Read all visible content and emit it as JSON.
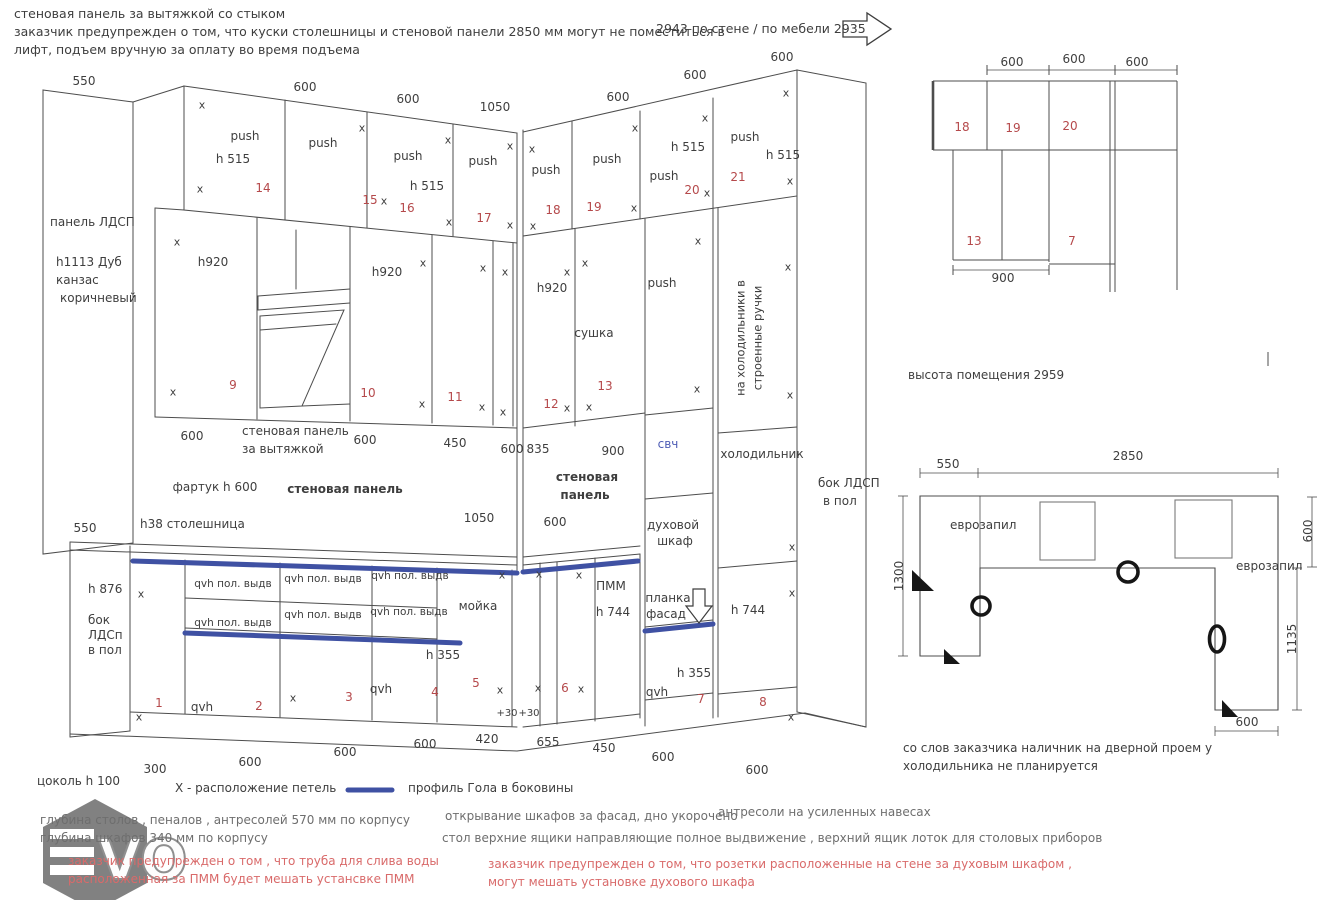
{
  "colors": {
    "ink": "#3e3e3e",
    "red": "#b5494b",
    "blue": "#4d5cb5",
    "gray": "#6e6e6e",
    "rednote": "#d96a6a",
    "gola_blue": "#3f51a3",
    "line": "#4d4d4d"
  },
  "watermark": {
    "v": "V",
    "o": "O"
  },
  "labels": [
    {
      "t": "стеновая панель за вытяжкой со стыком",
      "x": 14,
      "y": 14,
      "fs": 12.5,
      "al": "l",
      "n": "note-wall-panel"
    },
    {
      "t": "заказчик предупрежден о том, что куски столешницы и стеновой панели  2850 мм могут не поместиться в",
      "x": 14,
      "y": 32,
      "fs": 12.5,
      "al": "l",
      "n": "note-lift-1"
    },
    {
      "t": "лифт, подъем вручную за оплату во время подъема",
      "x": 14,
      "y": 50,
      "fs": 12.5,
      "al": "l",
      "n": "note-lift-2"
    },
    {
      "t": "2943 по стене / по мебели 2935",
      "x": 656,
      "y": 29,
      "fs": 12.5,
      "al": "l",
      "n": "wall-length-note"
    },
    {
      "t": "550",
      "x": 84,
      "y": 81
    },
    {
      "t": "600",
      "x": 305,
      "y": 87
    },
    {
      "t": "600",
      "x": 408,
      "y": 99
    },
    {
      "t": "1050",
      "x": 495,
      "y": 107
    },
    {
      "t": "600",
      "x": 618,
      "y": 97
    },
    {
      "t": "600",
      "x": 695,
      "y": 75
    },
    {
      "t": "600",
      "x": 782,
      "y": 57
    },
    {
      "t": "панель ЛДСП",
      "x": 50,
      "y": 222,
      "al": "l"
    },
    {
      "t": "h1113 Дуб",
      "x": 56,
      "y": 262,
      "al": "l"
    },
    {
      "t": "канзас",
      "x": 56,
      "y": 280,
      "al": "l"
    },
    {
      "t": "коричневый",
      "x": 60,
      "y": 298,
      "al": "l"
    },
    {
      "t": "push",
      "x": 245,
      "y": 136
    },
    {
      "t": "h  515",
      "x": 233,
      "y": 159
    },
    {
      "t": "14",
      "x": 263,
      "y": 188,
      "c": "red"
    },
    {
      "t": "push",
      "x": 323,
      "y": 143
    },
    {
      "t": "15",
      "x": 370,
      "y": 200,
      "c": "red"
    },
    {
      "t": "x",
      "x": 384,
      "y": 201,
      "fs": 11
    },
    {
      "t": "push",
      "x": 408,
      "y": 156
    },
    {
      "t": "h  515",
      "x": 427,
      "y": 186
    },
    {
      "t": "16",
      "x": 407,
      "y": 208,
      "c": "red"
    },
    {
      "t": "push",
      "x": 483,
      "y": 161
    },
    {
      "t": "17",
      "x": 484,
      "y": 218,
      "c": "red"
    },
    {
      "t": "push",
      "x": 546,
      "y": 170
    },
    {
      "t": "18",
      "x": 553,
      "y": 210,
      "c": "red"
    },
    {
      "t": "push",
      "x": 607,
      "y": 159
    },
    {
      "t": "19",
      "x": 594,
      "y": 207,
      "c": "red"
    },
    {
      "t": "h  515",
      "x": 688,
      "y": 147
    },
    {
      "t": "push",
      "x": 664,
      "y": 176
    },
    {
      "t": "20",
      "x": 692,
      "y": 190,
      "c": "red"
    },
    {
      "t": "push",
      "x": 745,
      "y": 137
    },
    {
      "t": "h  515",
      "x": 783,
      "y": 155
    },
    {
      "t": "21",
      "x": 738,
      "y": 177,
      "c": "red"
    },
    {
      "t": "x",
      "x": 202,
      "y": 105,
      "fs": 11
    },
    {
      "t": "x",
      "x": 200,
      "y": 189,
      "fs": 11
    },
    {
      "t": "x",
      "x": 362,
      "y": 128,
      "fs": 11
    },
    {
      "t": "x",
      "x": 448,
      "y": 140,
      "fs": 11
    },
    {
      "t": "x",
      "x": 449,
      "y": 222,
      "fs": 11
    },
    {
      "t": "x",
      "x": 510,
      "y": 146,
      "fs": 11
    },
    {
      "t": "x",
      "x": 510,
      "y": 225,
      "fs": 11
    },
    {
      "t": "x",
      "x": 532,
      "y": 149,
      "fs": 11
    },
    {
      "t": "x",
      "x": 533,
      "y": 226,
      "fs": 11
    },
    {
      "t": "x",
      "x": 635,
      "y": 128,
      "fs": 11
    },
    {
      "t": "x",
      "x": 634,
      "y": 208,
      "fs": 11
    },
    {
      "t": "x",
      "x": 705,
      "y": 118,
      "fs": 11
    },
    {
      "t": "x",
      "x": 707,
      "y": 193,
      "fs": 11
    },
    {
      "t": "x",
      "x": 786,
      "y": 93,
      "fs": 11
    },
    {
      "t": "x",
      "x": 790,
      "y": 181,
      "fs": 11
    },
    {
      "t": "h920",
      "x": 213,
      "y": 262
    },
    {
      "t": "9",
      "x": 233,
      "y": 385,
      "c": "red"
    },
    {
      "t": "h920",
      "x": 387,
      "y": 272
    },
    {
      "t": "10",
      "x": 368,
      "y": 393,
      "c": "red"
    },
    {
      "t": "11",
      "x": 455,
      "y": 397,
      "c": "red"
    },
    {
      "t": "h920",
      "x": 552,
      "y": 288
    },
    {
      "t": "12",
      "x": 551,
      "y": 404,
      "c": "red"
    },
    {
      "t": "сушка",
      "x": 594,
      "y": 333
    },
    {
      "t": "13",
      "x": 605,
      "y": 386,
      "c": "red"
    },
    {
      "t": "push",
      "x": 662,
      "y": 283
    },
    {
      "t": "x",
      "x": 177,
      "y": 242,
      "fs": 11
    },
    {
      "t": "x",
      "x": 173,
      "y": 392,
      "fs": 11
    },
    {
      "t": "x",
      "x": 423,
      "y": 263,
      "fs": 11
    },
    {
      "t": "x",
      "x": 422,
      "y": 404,
      "fs": 11
    },
    {
      "t": "x",
      "x": 483,
      "y": 268,
      "fs": 11
    },
    {
      "t": "x",
      "x": 482,
      "y": 407,
      "fs": 11
    },
    {
      "t": "x",
      "x": 505,
      "y": 272,
      "fs": 11
    },
    {
      "t": "x",
      "x": 503,
      "y": 412,
      "fs": 11
    },
    {
      "t": "x",
      "x": 567,
      "y": 272,
      "fs": 11
    },
    {
      "t": "x",
      "x": 567,
      "y": 408,
      "fs": 11
    },
    {
      "t": "x",
      "x": 585,
      "y": 263,
      "fs": 11
    },
    {
      "t": "x",
      "x": 589,
      "y": 407,
      "fs": 11
    },
    {
      "t": "x",
      "x": 698,
      "y": 241,
      "fs": 11
    },
    {
      "t": "x",
      "x": 697,
      "y": 389,
      "fs": 11
    },
    {
      "t": "x",
      "x": 788,
      "y": 267,
      "fs": 11
    },
    {
      "t": "x",
      "x": 790,
      "y": 395,
      "fs": 11
    },
    {
      "t": "на холодильники в",
      "x": 741,
      "y": 338,
      "r": -90,
      "fs": 11.5,
      "n": "fridge-handles-note"
    },
    {
      "t": "строенные ручки",
      "x": 758,
      "y": 338,
      "r": -90,
      "fs": 11.5,
      "n": "fridge-handles-note"
    },
    {
      "t": "600",
      "x": 192,
      "y": 436
    },
    {
      "t": "стеновая панель",
      "x": 242,
      "y": 431,
      "al": "l"
    },
    {
      "t": "за вытяжкой",
      "x": 242,
      "y": 449,
      "al": "l"
    },
    {
      "t": "600",
      "x": 365,
      "y": 440
    },
    {
      "t": "450",
      "x": 455,
      "y": 443
    },
    {
      "t": "600",
      "x": 512,
      "y": 449
    },
    {
      "t": "835",
      "x": 538,
      "y": 449
    },
    {
      "t": "900",
      "x": 613,
      "y": 451
    },
    {
      "t": "свч",
      "x": 668,
      "y": 444,
      "c": "blue",
      "n": "microwave-label"
    },
    {
      "t": "холодильник",
      "x": 762,
      "y": 454,
      "n": "fridge-label"
    },
    {
      "t": "бок ЛДСП",
      "x": 818,
      "y": 483,
      "al": "l"
    },
    {
      "t": "в пол",
      "x": 823,
      "y": 501,
      "al": "l"
    },
    {
      "t": "фартук h 600",
      "x": 215,
      "y": 487
    },
    {
      "t": "стеновая панель",
      "x": 345,
      "y": 489,
      "b": 1
    },
    {
      "t": "стеновая",
      "x": 587,
      "y": 477,
      "b": 1
    },
    {
      "t": "панель",
      "x": 585,
      "y": 495,
      "b": 1
    },
    {
      "t": "600",
      "x": 555,
      "y": 522
    },
    {
      "t": "h38 столешница",
      "x": 140,
      "y": 524,
      "al": "l"
    },
    {
      "t": "550",
      "x": 85,
      "y": 528
    },
    {
      "t": "1050",
      "x": 479,
      "y": 518
    },
    {
      "t": "духовой",
      "x": 673,
      "y": 525
    },
    {
      "t": "шкаф",
      "x": 675,
      "y": 541
    },
    {
      "t": "планка",
      "x": 668,
      "y": 598
    },
    {
      "t": "фасад",
      "x": 666,
      "y": 614
    },
    {
      "t": "h 744",
      "x": 748,
      "y": 610
    },
    {
      "t": "ПММ",
      "x": 611,
      "y": 586
    },
    {
      "t": "h 744",
      "x": 613,
      "y": 612
    },
    {
      "t": "h 876",
      "x": 88,
      "y": 589,
      "al": "l"
    },
    {
      "t": "бок",
      "x": 88,
      "y": 620,
      "al": "l"
    },
    {
      "t": "ЛДСп",
      "x": 88,
      "y": 635,
      "al": "l"
    },
    {
      "t": "в пол",
      "x": 88,
      "y": 650,
      "al": "l"
    },
    {
      "t": "x",
      "x": 141,
      "y": 594,
      "fs": 11
    },
    {
      "t": "x",
      "x": 139,
      "y": 717,
      "fs": 11
    },
    {
      "t": "x",
      "x": 293,
      "y": 698,
      "fs": 11
    },
    {
      "t": "x",
      "x": 502,
      "y": 575,
      "fs": 11
    },
    {
      "t": "x",
      "x": 500,
      "y": 690,
      "fs": 11
    },
    {
      "t": "x",
      "x": 539,
      "y": 574,
      "fs": 11
    },
    {
      "t": "x",
      "x": 538,
      "y": 688,
      "fs": 11
    },
    {
      "t": "x",
      "x": 579,
      "y": 575,
      "fs": 11
    },
    {
      "t": "x",
      "x": 581,
      "y": 689,
      "fs": 11
    },
    {
      "t": "x",
      "x": 792,
      "y": 547,
      "fs": 11
    },
    {
      "t": "x",
      "x": 792,
      "y": 593,
      "fs": 11
    },
    {
      "t": "x",
      "x": 791,
      "y": 717,
      "fs": 11
    },
    {
      "t": "qvh  пол. выдв",
      "x": 233,
      "y": 584,
      "fs": 10.5
    },
    {
      "t": "qvh  пол. выдв",
      "x": 233,
      "y": 623,
      "fs": 10.5
    },
    {
      "t": "qvh  пол. выдв",
      "x": 323,
      "y": 579,
      "fs": 10.5
    },
    {
      "t": "qvh  пол. выдв",
      "x": 323,
      "y": 615,
      "fs": 10.5
    },
    {
      "t": "qvh  пол. выдв",
      "x": 410,
      "y": 576,
      "fs": 10.5
    },
    {
      "t": "qvh  пол. выдв",
      "x": 409,
      "y": 612,
      "fs": 10.5
    },
    {
      "t": "qvh",
      "x": 202,
      "y": 707
    },
    {
      "t": "qvh",
      "x": 381,
      "y": 689
    },
    {
      "t": "qvh",
      "x": 657,
      "y": 692
    },
    {
      "t": "h 355",
      "x": 443,
      "y": 655
    },
    {
      "t": "h 355",
      "x": 694,
      "y": 673
    },
    {
      "t": "мойка",
      "x": 478,
      "y": 606,
      "n": "sink-label"
    },
    {
      "t": "1",
      "x": 159,
      "y": 703,
      "c": "red"
    },
    {
      "t": "2",
      "x": 259,
      "y": 706,
      "c": "red"
    },
    {
      "t": "3",
      "x": 349,
      "y": 697,
      "c": "red"
    },
    {
      "t": "4",
      "x": 435,
      "y": 692,
      "c": "red"
    },
    {
      "t": "5",
      "x": 476,
      "y": 683,
      "c": "red"
    },
    {
      "t": "6",
      "x": 565,
      "y": 688,
      "c": "red"
    },
    {
      "t": "7",
      "x": 701,
      "y": 699,
      "c": "red"
    },
    {
      "t": "8",
      "x": 763,
      "y": 702,
      "c": "red"
    },
    {
      "t": "+30",
      "x": 507,
      "y": 714,
      "fs": 10
    },
    {
      "t": "+30",
      "x": 529,
      "y": 714,
      "fs": 10
    },
    {
      "t": "300",
      "x": 155,
      "y": 769
    },
    {
      "t": "600",
      "x": 250,
      "y": 762
    },
    {
      "t": "600",
      "x": 345,
      "y": 752
    },
    {
      "t": "600",
      "x": 425,
      "y": 744
    },
    {
      "t": "420",
      "x": 487,
      "y": 739
    },
    {
      "t": "655",
      "x": 548,
      "y": 742
    },
    {
      "t": "450",
      "x": 604,
      "y": 748
    },
    {
      "t": "600",
      "x": 663,
      "y": 757
    },
    {
      "t": "600",
      "x": 757,
      "y": 770
    },
    {
      "t": "цоколь h 100",
      "x": 37,
      "y": 781,
      "al": "l"
    },
    {
      "t": "X - расположение петель",
      "x": 175,
      "y": 788,
      "al": "l",
      "n": "hinge-legend"
    },
    {
      "t": "профиль Гола в боковины",
      "x": 408,
      "y": 788,
      "al": "l",
      "n": "gola-legend"
    },
    {
      "t": "глубина столов , пеналов , антресолей 570 мм по корпусу",
      "x": 40,
      "y": 820,
      "c": "gray",
      "al": "l"
    },
    {
      "t": "глубина шкафов 340 мм по корпусу",
      "x": 40,
      "y": 838,
      "c": "gray",
      "al": "l"
    },
    {
      "t": "заказчик предупрежден о том , что труба для слива воды",
      "x": 68,
      "y": 861,
      "c": "rednote",
      "al": "l"
    },
    {
      "t": "расположенная за ПММ будет мешать устансвке ПММ",
      "x": 68,
      "y": 879,
      "c": "rednote",
      "al": "l"
    },
    {
      "t": "открывание   шкафов за фасад, дно укорочено",
      "x": 445,
      "y": 816,
      "c": "gray",
      "al": "l"
    },
    {
      "t": "антресоли на усиленных навесах",
      "x": 718,
      "y": 812,
      "c": "gray",
      "al": "l"
    },
    {
      "t": "стол    верхние ящики направляющие полное выдвижение , верхний  ящик лоток для столовых приборов",
      "x": 442,
      "y": 838,
      "c": "gray",
      "al": "l"
    },
    {
      "t": "заказчик предупрежден о том, что розетки расположенные на стене за духовым шкафом ,",
      "x": 488,
      "y": 864,
      "c": "rednote",
      "al": "l"
    },
    {
      "t": "могут мешать установке духового шкафа",
      "x": 488,
      "y": 882,
      "c": "rednote",
      "al": "l"
    },
    {
      "t": "600",
      "x": 1012,
      "y": 62
    },
    {
      "t": "600",
      "x": 1074,
      "y": 59
    },
    {
      "t": "600",
      "x": 1137,
      "y": 62
    },
    {
      "t": "18",
      "x": 962,
      "y": 127,
      "c": "red"
    },
    {
      "t": "19",
      "x": 1013,
      "y": 128,
      "c": "red"
    },
    {
      "t": "20",
      "x": 1070,
      "y": 126,
      "c": "red"
    },
    {
      "t": "13",
      "x": 974,
      "y": 241,
      "c": "red"
    },
    {
      "t": "7",
      "x": 1072,
      "y": 241,
      "c": "red"
    },
    {
      "t": "900",
      "x": 1003,
      "y": 278
    },
    {
      "t": "высота помещения 2959",
      "x": 908,
      "y": 375,
      "al": "l",
      "n": "room-height-note"
    },
    {
      "t": "550",
      "x": 948,
      "y": 464
    },
    {
      "t": "2850",
      "x": 1128,
      "y": 456
    },
    {
      "t": "еврозапил",
      "x": 950,
      "y": 525,
      "al": "l"
    },
    {
      "t": "еврозапил",
      "x": 1236,
      "y": 566,
      "al": "l"
    },
    {
      "t": "1300",
      "x": 899,
      "y": 576,
      "r": -90
    },
    {
      "t": "600",
      "x": 1308,
      "y": 531,
      "r": -90
    },
    {
      "t": "1135",
      "x": 1292,
      "y": 639,
      "r": -90
    },
    {
      "t": "600",
      "x": 1247,
      "y": 722
    },
    {
      "t": "со слов заказчика наличник на дверной проем у",
      "x": 903,
      "y": 748,
      "al": "l",
      "n": "door-trim-note"
    },
    {
      "t": "холодильника не планируется",
      "x": 903,
      "y": 766,
      "al": "l",
      "n": "door-trim-note"
    }
  ]
}
